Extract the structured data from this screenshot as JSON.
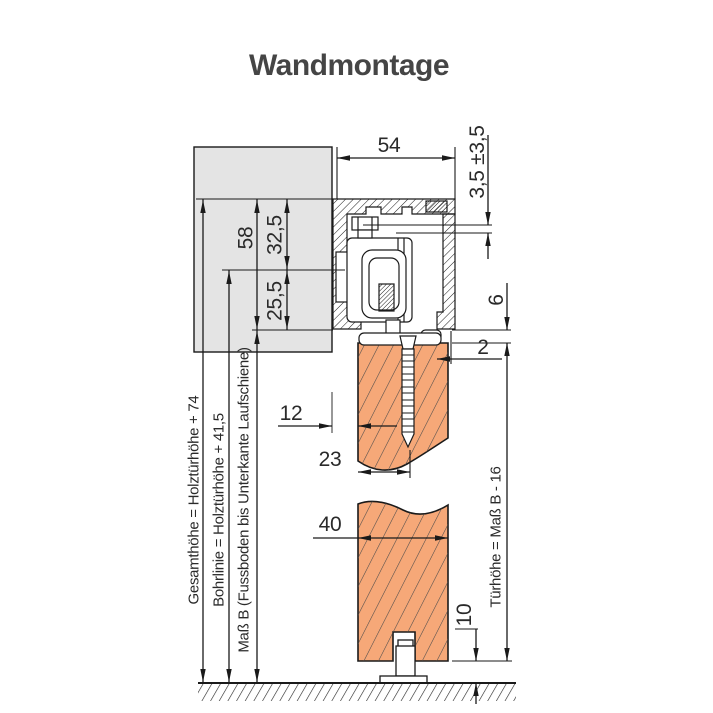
{
  "title": "Wandmontage",
  "colors": {
    "wall_fill": "#e4e4e4",
    "door_fill": "#f6a878",
    "line": "#1a1a1a",
    "title_color": "#454545"
  },
  "dims": {
    "width54": "54",
    "adjust35": "3,5 ±3,5",
    "h58": "58",
    "h325": "32,5",
    "h255": "25,5",
    "gap6": "6",
    "offset2": "2",
    "wallgap12": "12",
    "screw23": "23",
    "thick40": "40",
    "floor10": "10"
  },
  "notes": {
    "gesamthoehe": "Gesamthöhe = Holztürhöhe + 74",
    "bohrlinie": "Bohrlinie = Holztürhöhe + 41,5",
    "massb": "Maß B (Fussboden bis Unterkante Laufschiene)",
    "tuerhoehe": "Türhöhe = Maß B - 16"
  }
}
